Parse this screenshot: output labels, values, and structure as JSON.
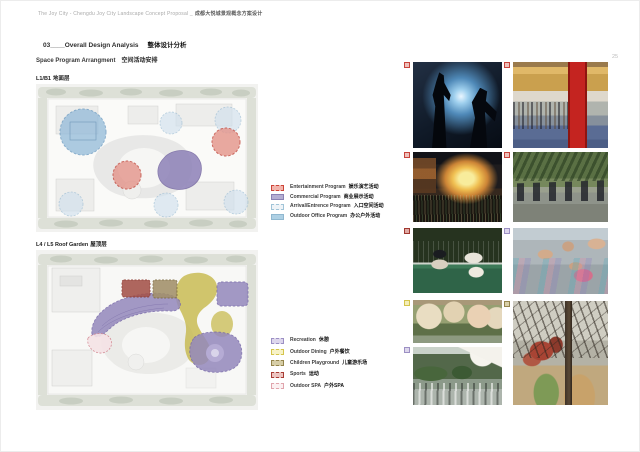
{
  "page": {
    "header_en": "The Joy City - Chengdu Joy City Landscape Concept Proposal _",
    "header_cn": "成都大悦城景观概念方案设计",
    "page_number": "25",
    "section_line_en": "03____Overall Design Analysis",
    "section_line_cn": "整体设计分析",
    "subtitle_en": "Space Program Arrangment",
    "subtitle_cn": "空间活动安排"
  },
  "plans": [
    {
      "id": "plan-l1b1",
      "label_en": "L1/B1",
      "label_cn": "地面层"
    },
    {
      "id": "plan-roof",
      "label_en": "L4 / L5 Roof Garden",
      "label_cn": "屋顶层"
    }
  ],
  "legend_program": {
    "items": [
      {
        "label_en": "Entertainment Program",
        "label_cn": "娱乐演艺活动",
        "fill": "#f2b4ac",
        "border": "#cc4438",
        "border_style": "dashed"
      },
      {
        "label_en": "Commercial Program",
        "label_cn": "商业展示活动",
        "fill": "#b4aed2",
        "border": "#8a82b4",
        "border_style": "solid"
      },
      {
        "label_en": "Arrival/Entrence Program",
        "label_cn": "入口空间活动",
        "fill": "#eef3f7",
        "border": "#a0c4d8",
        "border_style": "dashed"
      },
      {
        "label_en": "Outdoor Office Program",
        "label_cn": "办公户外活动",
        "fill": "#aed0e4",
        "border": "#90b8d0",
        "border_style": "solid"
      }
    ]
  },
  "legend_activity": {
    "items": [
      {
        "label_en": "Recreation",
        "label_cn": "休憩",
        "fill": "#ddd6ec",
        "border": "#9c90c4",
        "border_style": "dashed"
      },
      {
        "label_en": "Outdoor Dining",
        "label_cn": "户外餐饮",
        "fill": "#f7f2c6",
        "border": "#d4c44c",
        "border_style": "dashed"
      },
      {
        "label_en": "Children Playground",
        "label_cn": "儿童游乐场",
        "fill": "#d6cda6",
        "border": "#94844c",
        "border_style": "dashed"
      },
      {
        "label_en": "Sports",
        "label_cn": "运动",
        "fill": "#ecc4c0",
        "border": "#a83c34",
        "border_style": "dashed"
      },
      {
        "label_en": "Outdoor SPA",
        "label_cn": "户外SPA",
        "fill": "#fbf0f1",
        "border": "#e0a4ac",
        "border_style": "dashed"
      }
    ]
  },
  "photos": [
    {
      "name": "concert-performance",
      "marker_color": "#c8443c",
      "marker_fill": "#eec2bc"
    },
    {
      "name": "mall-event-crowd",
      "marker_color": "#c8443c",
      "marker_fill": "#eec2bc"
    },
    {
      "name": "outdoor-movie-night",
      "marker_color": "#c8443c",
      "marker_fill": "#eec2bc"
    },
    {
      "name": "outdoor-group-exercise",
      "marker_color": "#c8443c",
      "marker_fill": "#eec2bc"
    },
    {
      "name": "tennis-match",
      "marker_color": "#a03830",
      "marker_fill": "#e0aaa4"
    },
    {
      "name": "outdoor-yoga",
      "marker_color": "#9c90c4",
      "marker_fill": "#ddd6ec"
    },
    {
      "name": "umbrella-terrace",
      "marker_color": "#d4c44c",
      "marker_fill": "#f4eeb8"
    },
    {
      "name": "outdoor-dining-terrace",
      "marker_color": "#9c90c4",
      "marker_fill": "#ddd6ec"
    },
    {
      "name": "children-playground",
      "marker_color": "#94844c",
      "marker_fill": "#d9d0a8"
    }
  ]
}
